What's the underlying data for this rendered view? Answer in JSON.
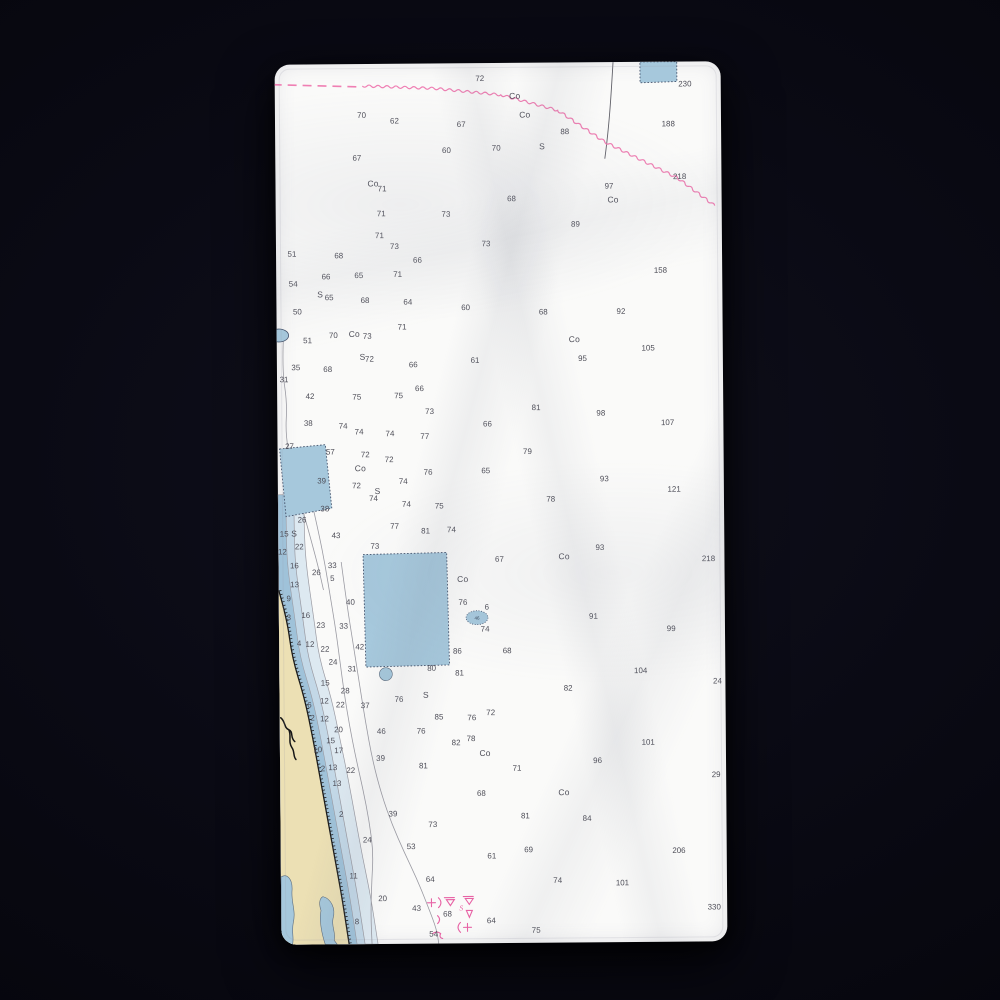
{
  "colors": {
    "background": "#0a0a14",
    "towel": "#fafaf9",
    "shallow_dark": "#9fc2d9",
    "shallow_mid": "#c3d8e7",
    "shallow_pale": "#dde9f1",
    "water_feature": "#a6c8dc",
    "water_feature_border": "#44526b",
    "land": "#ece0b4",
    "contour_gray": "#9a9aa2",
    "sounding_text": "#4e4e58",
    "magenta": "#e763a5",
    "magenta_light": "#ef7fb3",
    "shoreline": "#1c1c1c",
    "cable_gray": "#606068"
  },
  "labels": {
    "obstruction_oval": "46"
  },
  "magenta_labels": [
    [
      181,
      851,
      "S"
    ]
  ],
  "soundings": [
    [
      206,
      18,
      "72"
    ],
    [
      412,
      25,
      "230"
    ],
    [
      241,
      36,
      "Co"
    ],
    [
      251,
      55,
      "Co"
    ],
    [
      87,
      54,
      "70"
    ],
    [
      120,
      60,
      "62"
    ],
    [
      187,
      64,
      "67"
    ],
    [
      291,
      72,
      "88"
    ],
    [
      395,
      65,
      "188"
    ],
    [
      82,
      97,
      "67"
    ],
    [
      172,
      90,
      "60"
    ],
    [
      222,
      88,
      "70"
    ],
    [
      268,
      87,
      "S"
    ],
    [
      98,
      123,
      "Co"
    ],
    [
      107,
      128,
      "71"
    ],
    [
      335,
      127,
      "97"
    ],
    [
      339,
      141,
      "Co"
    ],
    [
      406,
      118,
      "218"
    ],
    [
      237,
      139,
      "68"
    ],
    [
      106,
      153,
      "71"
    ],
    [
      171,
      154,
      "73"
    ],
    [
      301,
      165,
      "89"
    ],
    [
      104,
      175,
      "71"
    ],
    [
      119,
      186,
      "73"
    ],
    [
      211,
      184,
      "73"
    ],
    [
      16,
      193,
      "51"
    ],
    [
      63,
      195,
      "68"
    ],
    [
      142,
      200,
      "66"
    ],
    [
      386,
      212,
      "158"
    ],
    [
      17,
      223,
      "54"
    ],
    [
      50,
      216,
      "66"
    ],
    [
      83,
      215,
      "65"
    ],
    [
      122,
      214,
      "71"
    ],
    [
      44,
      234,
      "S"
    ],
    [
      53,
      237,
      "65"
    ],
    [
      89,
      240,
      "68"
    ],
    [
      132,
      242,
      "64"
    ],
    [
      190,
      248,
      "60"
    ],
    [
      268,
      253,
      "68"
    ],
    [
      346,
      253,
      "92"
    ],
    [
      21,
      251,
      "50"
    ],
    [
      126,
      267,
      "71"
    ],
    [
      31,
      280,
      "51"
    ],
    [
      57,
      275,
      "70"
    ],
    [
      78,
      274,
      "Co"
    ],
    [
      91,
      276,
      "73"
    ],
    [
      299,
      281,
      "Co"
    ],
    [
      373,
      290,
      "105"
    ],
    [
      86,
      297,
      "S"
    ],
    [
      93,
      299,
      "72"
    ],
    [
      137,
      305,
      "66"
    ],
    [
      199,
      301,
      "61"
    ],
    [
      307,
      300,
      "95"
    ],
    [
      19,
      307,
      "35"
    ],
    [
      51,
      309,
      "68"
    ],
    [
      7,
      319,
      "31"
    ],
    [
      143,
      329,
      "66"
    ],
    [
      33,
      336,
      "42"
    ],
    [
      80,
      337,
      "75"
    ],
    [
      122,
      336,
      "75"
    ],
    [
      153,
      352,
      "73"
    ],
    [
      260,
      349,
      "81"
    ],
    [
      325,
      355,
      "98"
    ],
    [
      392,
      365,
      "107"
    ],
    [
      31,
      363,
      "38"
    ],
    [
      66,
      366,
      "74"
    ],
    [
      82,
      372,
      "74"
    ],
    [
      113,
      374,
      "74"
    ],
    [
      148,
      377,
      "77"
    ],
    [
      211,
      365,
      "66"
    ],
    [
      12,
      386,
      "27"
    ],
    [
      53,
      392,
      "57"
    ],
    [
      88,
      395,
      "72"
    ],
    [
      112,
      400,
      "72"
    ],
    [
      251,
      393,
      "79"
    ],
    [
      83,
      409,
      "Co"
    ],
    [
      151,
      413,
      "76"
    ],
    [
      209,
      412,
      "65"
    ],
    [
      44,
      421,
      "39"
    ],
    [
      328,
      421,
      "93"
    ],
    [
      79,
      426,
      "72"
    ],
    [
      126,
      422,
      "74"
    ],
    [
      398,
      432,
      "121"
    ],
    [
      100,
      432,
      "S"
    ],
    [
      96,
      439,
      "74"
    ],
    [
      129,
      445,
      "74"
    ],
    [
      162,
      447,
      "75"
    ],
    [
      274,
      441,
      "78"
    ],
    [
      47,
      449,
      "38"
    ],
    [
      24,
      460,
      "26"
    ],
    [
      16,
      474,
      "S"
    ],
    [
      6,
      474,
      "15"
    ],
    [
      58,
      476,
      "43"
    ],
    [
      21,
      487,
      "22"
    ],
    [
      4,
      492,
      "12"
    ],
    [
      97,
      487,
      "73"
    ],
    [
      117,
      467,
      "77"
    ],
    [
      148,
      472,
      "81"
    ],
    [
      174,
      471,
      "74"
    ],
    [
      16,
      506,
      "16"
    ],
    [
      54,
      506,
      "33"
    ],
    [
      38,
      513,
      "26"
    ],
    [
      54,
      519,
      "5"
    ],
    [
      16,
      525,
      "13"
    ],
    [
      185,
      521,
      "Co"
    ],
    [
      222,
      501,
      "67"
    ],
    [
      287,
      499,
      "Co"
    ],
    [
      323,
      490,
      "93"
    ],
    [
      432,
      502,
      "218"
    ],
    [
      72,
      543,
      "40"
    ],
    [
      185,
      544,
      "76"
    ],
    [
      209,
      549,
      "6"
    ],
    [
      10,
      539,
      "9"
    ],
    [
      10,
      558,
      "3"
    ],
    [
      27,
      556,
      "16"
    ],
    [
      42,
      566,
      "23"
    ],
    [
      65,
      567,
      "33"
    ],
    [
      207,
      571,
      "74"
    ],
    [
      316,
      559,
      "91"
    ],
    [
      394,
      572,
      "99"
    ],
    [
      20,
      584,
      "4"
    ],
    [
      31,
      585,
      "12"
    ],
    [
      46,
      590,
      "22"
    ],
    [
      81,
      588,
      "42"
    ],
    [
      179,
      593,
      "86"
    ],
    [
      229,
      593,
      "68"
    ],
    [
      54,
      603,
      "24"
    ],
    [
      73,
      610,
      "31"
    ],
    [
      153,
      610,
      "80"
    ],
    [
      181,
      615,
      "81"
    ],
    [
      363,
      614,
      "104"
    ],
    [
      440,
      625,
      "24"
    ],
    [
      46,
      624,
      "15"
    ],
    [
      66,
      632,
      "28"
    ],
    [
      45,
      642,
      "12"
    ],
    [
      61,
      646,
      "22"
    ],
    [
      86,
      647,
      "37"
    ],
    [
      147,
      637,
      "S"
    ],
    [
      120,
      641,
      "76"
    ],
    [
      30,
      646,
      "6"
    ],
    [
      33,
      659,
      "2"
    ],
    [
      45,
      660,
      "12"
    ],
    [
      160,
      659,
      "85"
    ],
    [
      193,
      660,
      "76"
    ],
    [
      212,
      655,
      "72"
    ],
    [
      290,
      631,
      "82"
    ],
    [
      59,
      671,
      "20"
    ],
    [
      102,
      673,
      "46"
    ],
    [
      51,
      682,
      "15"
    ],
    [
      38,
      691,
      "10"
    ],
    [
      59,
      692,
      "17"
    ],
    [
      101,
      700,
      "39"
    ],
    [
      43,
      710,
      "2"
    ],
    [
      53,
      709,
      "13"
    ],
    [
      71,
      712,
      "22"
    ],
    [
      57,
      725,
      "13"
    ],
    [
      142,
      673,
      "76"
    ],
    [
      177,
      685,
      "82"
    ],
    [
      192,
      681,
      "78"
    ],
    [
      206,
      696,
      "Co"
    ],
    [
      370,
      686,
      "101"
    ],
    [
      144,
      708,
      "81"
    ],
    [
      319,
      704,
      "96"
    ],
    [
      238,
      711,
      "71"
    ],
    [
      202,
      736,
      "68"
    ],
    [
      285,
      736,
      "Co"
    ],
    [
      113,
      756,
      "39"
    ],
    [
      61,
      756,
      "2"
    ],
    [
      246,
      759,
      "81"
    ],
    [
      308,
      762,
      "84"
    ],
    [
      153,
      767,
      "73"
    ],
    [
      87,
      782,
      "24"
    ],
    [
      131,
      789,
      "53"
    ],
    [
      212,
      799,
      "61"
    ],
    [
      249,
      793,
      "69"
    ],
    [
      400,
      795,
      "206"
    ],
    [
      438,
      719,
      "29"
    ],
    [
      150,
      822,
      "64"
    ],
    [
      278,
      824,
      "74"
    ],
    [
      343,
      827,
      "101"
    ],
    [
      73,
      818,
      "11"
    ],
    [
      102,
      841,
      "20"
    ],
    [
      136,
      851,
      "43"
    ],
    [
      167,
      857,
      "68"
    ],
    [
      211,
      864,
      "64"
    ],
    [
      256,
      874,
      "75"
    ],
    [
      435,
      852,
      "330"
    ],
    [
      76,
      864,
      "8"
    ],
    [
      153,
      877,
      "54"
    ]
  ]
}
